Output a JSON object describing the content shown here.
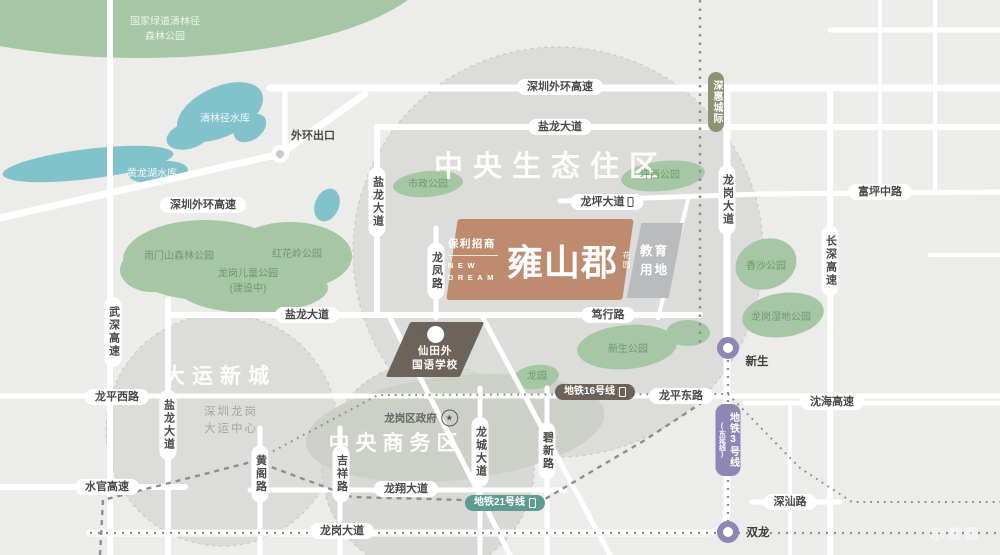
{
  "colors": {
    "background": "#ececea",
    "district_circle": "#dcdcda",
    "park": "#a6c7a3",
    "water": "#82c2cb",
    "road": "#ffffff",
    "project_block": "#bf8b6e",
    "education_block": "#b9bbbd",
    "school_block": "#6c635b",
    "metro3": "#8d87b3",
    "metro16": "#6d6158",
    "metro21": "#5f9b90",
    "intercity": "#8f9273",
    "pill_text": "#4a4a48",
    "park_text": "#6d9a6f"
  },
  "project": {
    "brand": "保利招商",
    "en_line1": "NEW",
    "en_line2": "DREAM",
    "name": "雍山郡",
    "name_suffix": "花园"
  },
  "education_plot": {
    "line1": "教育",
    "line2": "用地"
  },
  "school": {
    "line1": "仙田外",
    "line2": "国语学校"
  },
  "government": {
    "label": "龙岗区政府",
    "star_icon": "★"
  },
  "highway_exit": {
    "label": "外环出口"
  },
  "watermark": {
    "label": "示意图"
  },
  "districts": [
    {
      "id": "central-eco-district",
      "lines": [
        "中央生态住区"
      ],
      "x": 551,
      "y": 167,
      "size": 29,
      "ls": 10
    },
    {
      "id": "dayun-new-town",
      "lines": [
        "大运新城"
      ],
      "x": 220,
      "y": 377,
      "size": 21,
      "ls": 7
    },
    {
      "id": "central-business-district",
      "lines": [
        "中央商务区"
      ],
      "x": 396,
      "y": 444,
      "size": 21,
      "ls": 6
    }
  ],
  "district_notes": [
    {
      "id": "dayun-center-note",
      "lines": [
        "深圳龙岗",
        "大运中心"
      ],
      "x": 231,
      "y": 421
    }
  ],
  "road_labels_h": [
    {
      "id": "shenzhen-outer-ring-expwy-top",
      "label": "深圳外环高速",
      "x": 560,
      "y": 87
    },
    {
      "id": "yanlong-avenue-top",
      "label": "盐龙大道",
      "x": 560,
      "y": 127
    },
    {
      "id": "shenzhen-outer-ring-expwy-left",
      "label": "深圳外环高速",
      "x": 203,
      "y": 205
    },
    {
      "id": "fuping-middle-road",
      "label": "富坪中路",
      "x": 880,
      "y": 192
    },
    {
      "id": "longping-avenue",
      "label": "龙坪大道",
      "x": 607,
      "y": 202,
      "icon": true
    },
    {
      "id": "yanlong-avenue-mid",
      "label": "盐龙大道",
      "x": 307,
      "y": 315
    },
    {
      "id": "duxing-road",
      "label": "笃行路",
      "x": 608,
      "y": 315
    },
    {
      "id": "longping-west-road",
      "label": "龙平西路",
      "x": 117,
      "y": 397
    },
    {
      "id": "longping-east-road",
      "label": "龙平东路",
      "x": 681,
      "y": 396
    },
    {
      "id": "shenhai-expwy",
      "label": "沈海高速",
      "x": 832,
      "y": 402
    },
    {
      "id": "shuiguan-expwy",
      "label": "水官高速",
      "x": 107,
      "y": 487
    },
    {
      "id": "longxiang-avenue",
      "label": "龙翔大道",
      "x": 406,
      "y": 489
    },
    {
      "id": "shenshan-road",
      "label": "深汕路",
      "x": 790,
      "y": 502
    },
    {
      "id": "longgang-avenue-south",
      "label": "龙岗大道",
      "x": 342,
      "y": 531
    }
  ],
  "road_labels_v": [
    {
      "id": "yanlong-avenue-north",
      "label": "盐龙大道",
      "x": 377,
      "y": 202
    },
    {
      "id": "longgang-avenue-north",
      "label": "龙岗大道",
      "x": 727,
      "y": 200
    },
    {
      "id": "changshen-expwy",
      "label": "长深高速",
      "x": 830,
      "y": 261
    },
    {
      "id": "wushen-expwy",
      "label": "武深高速",
      "x": 113,
      "y": 332
    },
    {
      "id": "longfeng-road",
      "label": "龙凤路",
      "x": 436,
      "y": 271
    },
    {
      "id": "yanlong-avenue-south",
      "label": "盐龙大道",
      "x": 168,
      "y": 425
    },
    {
      "id": "huangge-road",
      "label": "黄阁路",
      "x": 260,
      "y": 474
    },
    {
      "id": "jixiang-road",
      "label": "吉祥路",
      "x": 341,
      "y": 474
    },
    {
      "id": "longcheng-avenue",
      "label": "龙城大道",
      "x": 480,
      "y": 452
    },
    {
      "id": "bixin-road",
      "label": "碧新路",
      "x": 547,
      "y": 451
    }
  ],
  "metro_labels": [
    {
      "id": "shenhui-intercity",
      "label": "深惠城际",
      "x": 716,
      "y": 102,
      "orient": "v",
      "color": "#8f9273"
    },
    {
      "id": "metro-line-16",
      "label": "地铁16号线",
      "x": 595,
      "y": 392,
      "orient": "h",
      "color": "#6d6158",
      "icon": true
    },
    {
      "id": "metro-line-21",
      "label": "地铁21号线",
      "x": 505,
      "y": 503,
      "orient": "h",
      "color": "#5f9b90",
      "icon": true
    },
    {
      "id": "metro-line-3",
      "label": "地铁3号线",
      "sub": "(东延线)",
      "x": 728,
      "y": 440,
      "orient": "v",
      "color": "#8d87b3"
    }
  ],
  "stations": [
    {
      "id": "station-xinsheng",
      "label": "新生",
      "x": 728,
      "y": 348,
      "lx": 757,
      "ly": 361
    },
    {
      "id": "station-shuanglong",
      "label": "双龙",
      "x": 728,
      "y": 532,
      "lx": 758,
      "ly": 532
    }
  ],
  "park_labels": [
    {
      "id": "qinglinjing-forest-park",
      "lines": [
        "国家绿道清林径",
        "森林公园"
      ],
      "x": 165,
      "y": 30,
      "pale": true
    },
    {
      "id": "yumenshan-forest-park",
      "lines": [
        "雨门山森林公园"
      ],
      "x": 179,
      "y": 257
    },
    {
      "id": "honghualing-park",
      "lines": [
        "红花岭公园"
      ],
      "x": 297,
      "y": 255
    },
    {
      "id": "longgang-children-park",
      "lines": [
        "龙岗儿童公园",
        "(建设中)"
      ],
      "x": 248,
      "y": 282
    },
    {
      "id": "shizheng-park",
      "lines": [
        "市政公园"
      ],
      "x": 428,
      "y": 185
    },
    {
      "id": "pingxi-park",
      "lines": [
        "坪西公园"
      ],
      "x": 660,
      "y": 176
    },
    {
      "id": "xiangsha-park",
      "lines": [
        "香沙公园"
      ],
      "x": 766,
      "y": 267
    },
    {
      "id": "longgang-wetland-park",
      "lines": [
        "龙岗湿地公园"
      ],
      "x": 781,
      "y": 318
    },
    {
      "id": "xinsheng-park",
      "lines": [
        "新生公园"
      ],
      "x": 628,
      "y": 350
    },
    {
      "id": "longyuan-park",
      "lines": [
        "龙园"
      ],
      "x": 537,
      "y": 377
    }
  ],
  "water_labels": [
    {
      "id": "qinglinjing-reservoir",
      "label": "清林径水库",
      "x": 225,
      "y": 117
    },
    {
      "id": "huanglonghu-reservoir",
      "label": "黄龙湖水库",
      "x": 152,
      "y": 172
    }
  ]
}
